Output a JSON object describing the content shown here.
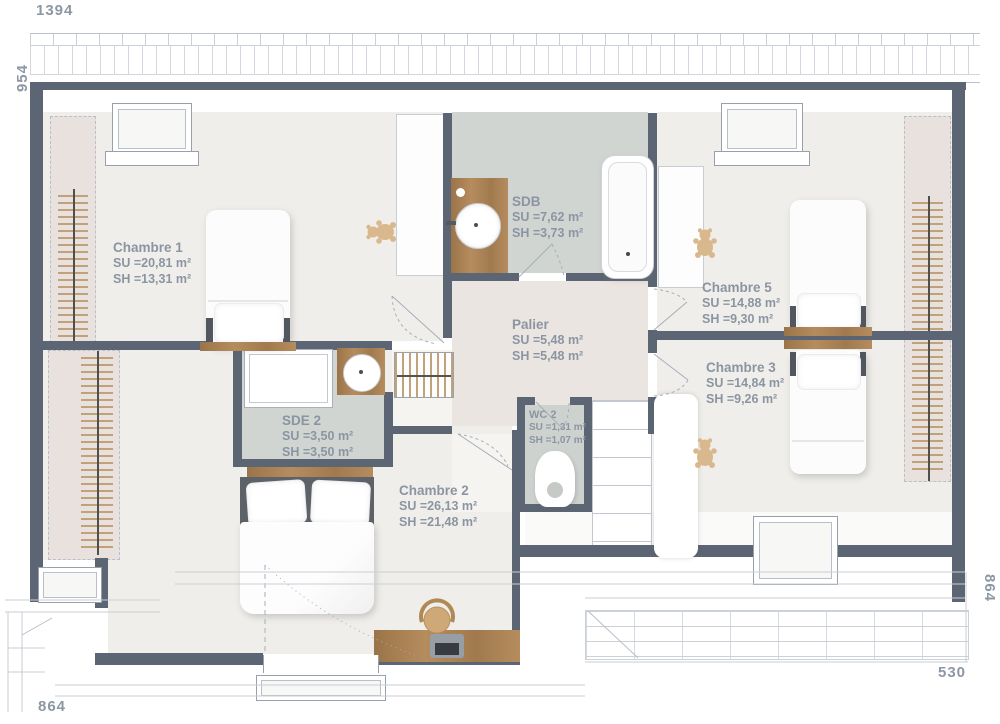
{
  "title": "Floor plan - upper storey",
  "dimensions": {
    "top": "1394",
    "left": "954",
    "right": "864",
    "bottom_left": "864",
    "bottom_right": "530"
  },
  "rooms": {
    "chambre1": {
      "name": "Chambre 1",
      "su": "SU =20,81 m²",
      "sh": "SH =13,31 m²"
    },
    "sdb": {
      "name": "SDB",
      "su": "SU =7,62 m²",
      "sh": "SH =3,73 m²"
    },
    "chambre5": {
      "name": "Chambre 5",
      "su": "SU =14,88 m²",
      "sh": "SH =9,30 m²"
    },
    "chambre3": {
      "name": "Chambre 3",
      "su": "SU =14,84 m²",
      "sh": "SH =9,26 m²"
    },
    "palier": {
      "name": "Palier",
      "su": "SU =5,48 m²",
      "sh": "SH =5,48 m²"
    },
    "sde2": {
      "name": "SDE 2",
      "su": "SU =3,50 m²",
      "sh": "SH =3,50 m²"
    },
    "wc2": {
      "name": "WC 2",
      "su": "SU =1,31 m²",
      "sh": "SH =1,07 m²"
    },
    "chambre2": {
      "name": "Chambre 2",
      "su": "SU =26,13 m²",
      "sh": "SH =21,48 m²"
    }
  },
  "colors": {
    "wall": "#5b6573",
    "floor": "#f0eeea",
    "wet_floor": "#d1d5d2",
    "palier_floor": "#ebe5e1",
    "slope_zone": "#e9e1dd",
    "wood": "#a9825a",
    "hatch": "#c2a277",
    "label_text": "#8b95a2"
  }
}
